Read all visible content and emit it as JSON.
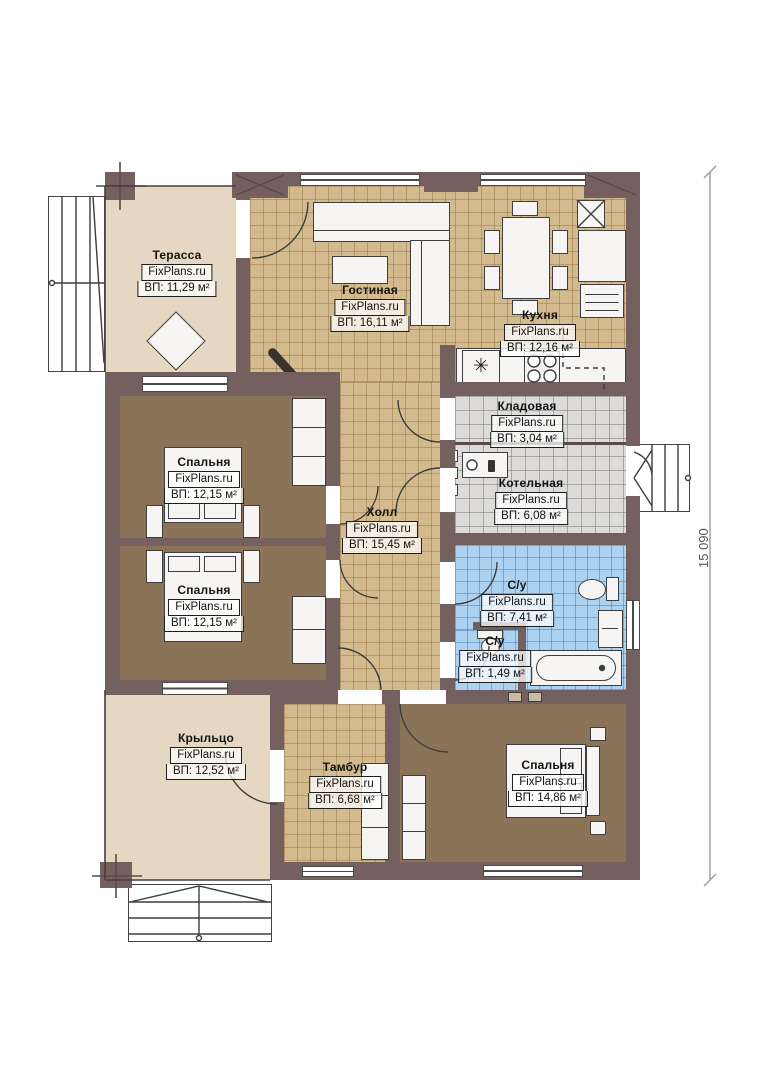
{
  "plan": {
    "brand": "FixPlans.ru",
    "dimension": {
      "height_label": "15 090"
    },
    "rooms": {
      "terrace": {
        "name": "Терасса",
        "brand": "FixPlans.ru",
        "area": "ВП: 11,29 м²"
      },
      "living": {
        "name": "Гостиная",
        "brand": "FixPlans.ru",
        "area": "ВП: 16,11 м²"
      },
      "kitchen": {
        "name": "Кухня",
        "brand": "FixPlans.ru",
        "area": "ВП: 12,16 м²"
      },
      "pantry": {
        "name": "Кладовая",
        "brand": "FixPlans.ru",
        "area": "ВП: 3,04 м²"
      },
      "boiler": {
        "name": "Котельная",
        "brand": "FixPlans.ru",
        "area": "ВП: 6,08 м²"
      },
      "bedroom1": {
        "name": "Спальня",
        "brand": "FixPlans.ru",
        "area": "ВП: 12,15 м²"
      },
      "bedroom2": {
        "name": "Спальня",
        "brand": "FixPlans.ru",
        "area": "ВП: 12,15 м²"
      },
      "hall": {
        "name": "Холл",
        "brand": "FixPlans.ru",
        "area": "ВП: 15,45 м²"
      },
      "bathroom": {
        "name": "С/у",
        "brand": "FixPlans.ru",
        "area": "ВП: 7,41 м²"
      },
      "wc": {
        "name": "С/у",
        "brand": "FixPlans.ru",
        "area": "ВП: 1,49 м²"
      },
      "porch": {
        "name": "Крыльцо",
        "brand": "FixPlans.ru",
        "area": "ВП: 12,52 м²"
      },
      "vestibule": {
        "name": "Тамбур",
        "brand": "FixPlans.ru",
        "area": "ВП: 6,68 м²"
      },
      "bedroom3": {
        "name": "Спальня",
        "brand": "FixPlans.ru",
        "area": "ВП: 14,86 м²"
      }
    },
    "colors": {
      "wall": "#74605f",
      "tile_floor": "#d4ba8f",
      "bedroom_floor": "#8a7356",
      "terrace_floor": "#e5d7c1",
      "service_floor": "#dcdbd9",
      "bath_floor": "#abd2f0"
    }
  }
}
